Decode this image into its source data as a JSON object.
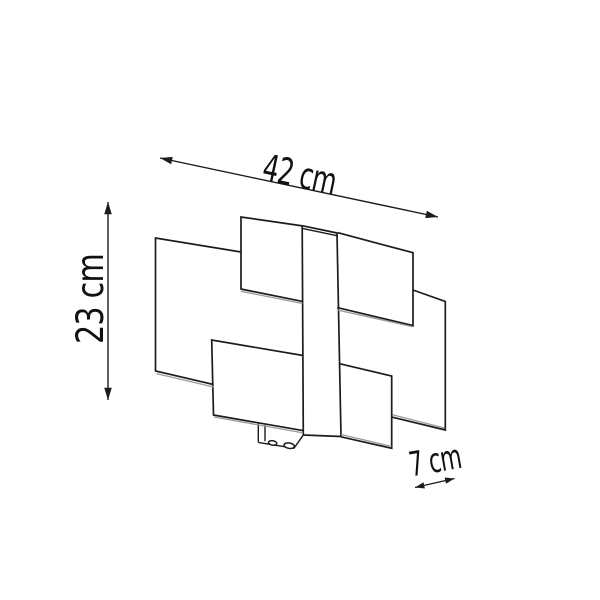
{
  "page": {
    "background_color": "#ffffff"
  },
  "diagram": {
    "kind": "product-dimension-line-drawing",
    "subject": "wall-lamp-with-overlapping-glass-panels",
    "line_color": "#1c1c1c",
    "thickness_line_color": "#9b9b9b",
    "text_color": "#111111",
    "dimensions": {
      "width": {
        "label": "42 cm",
        "value": 42,
        "unit": "cm"
      },
      "height": {
        "label": "23 cm",
        "value": 23,
        "unit": "cm"
      },
      "depth": {
        "label": "7 cm",
        "value": 7,
        "unit": "cm"
      }
    }
  }
}
